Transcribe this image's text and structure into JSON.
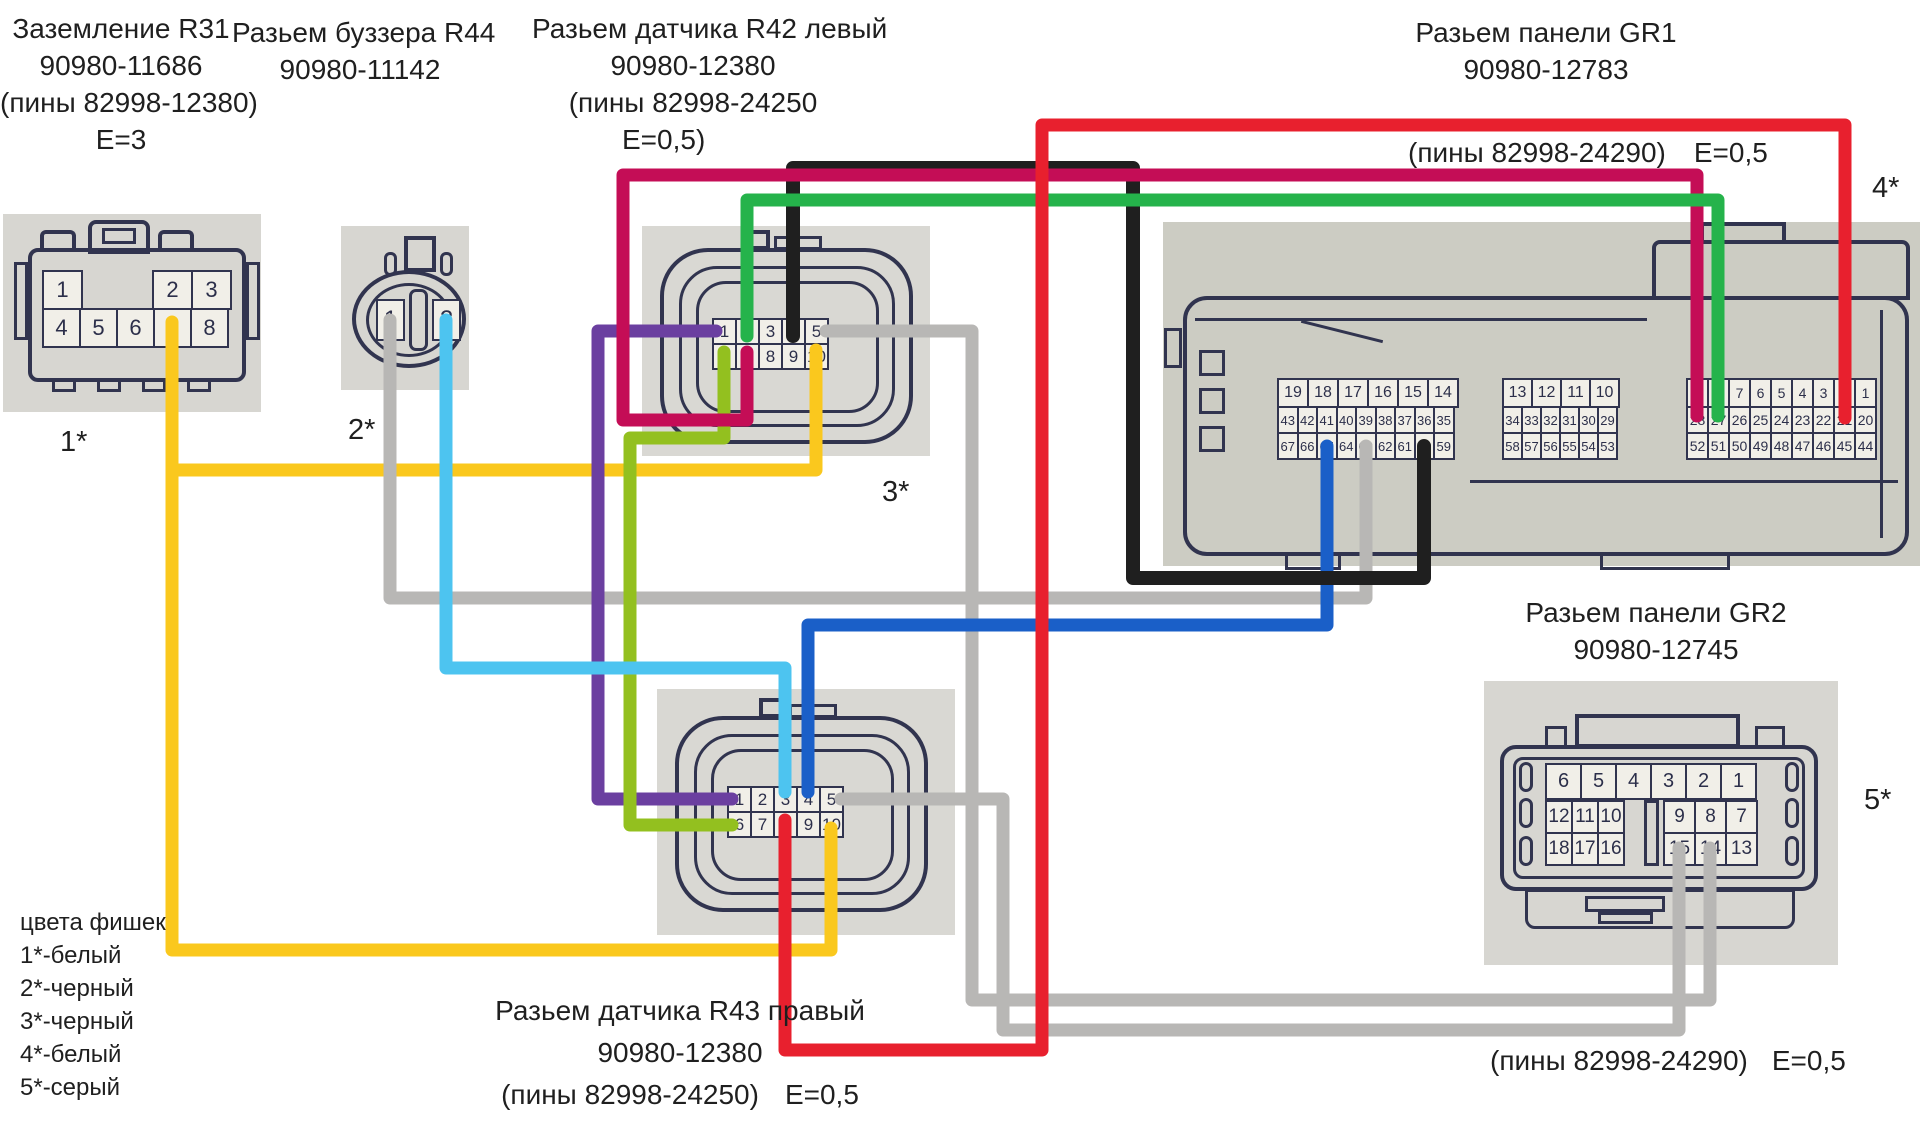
{
  "labels": {
    "r31": {
      "line1": "Заземление R31",
      "line2": "90980-11686",
      "line3": "(пины 82998-12380)",
      "line4": "Е=3",
      "tag": "1*"
    },
    "r44": {
      "line1": "Разьем буззера R44",
      "line2": "90980-11142",
      "tag": "2*"
    },
    "r42": {
      "line1": "Разьем датчика R42 левый",
      "line2": "90980-12380",
      "line3": "(пины 82998-24250",
      "line4": "Е=0,5)",
      "tag": "3*"
    },
    "gr1": {
      "line1": "Разьем панели GR1",
      "line2": "90980-12783",
      "pins_note": "(пины 82998-24290)",
      "e_note": "Е=0,5",
      "tag": "4*"
    },
    "gr2": {
      "line1": "Разьем панели GR2",
      "line2": "90980-12745",
      "pins_note": "(пины 82998-24290)",
      "e_note": "Е=0,5",
      "tag": "5*"
    },
    "r43": {
      "line1": "Разьем датчика R43 правый",
      "line2": "90980-12380",
      "line3": "(пины 82998-24250)",
      "e_note": "Е=0,5"
    }
  },
  "legend": {
    "title": "цвета фишек",
    "items": [
      "1*-белый",
      "2*-черный",
      "3*-черный",
      "4*-белый",
      "5*-серый"
    ]
  },
  "connectors": {
    "r31": {
      "row1a": [
        "1"
      ],
      "row1b": [
        "2",
        "3"
      ],
      "row2": [
        "4",
        "5",
        "6",
        "7",
        "8"
      ]
    },
    "r44": {
      "pins": [
        "1",
        "2"
      ]
    },
    "r42": {
      "row1": [
        "1",
        "2",
        "3",
        "4",
        "5"
      ],
      "row2": [
        "6",
        "7",
        "8",
        "9",
        "10"
      ]
    },
    "r43": {
      "row1": [
        "1",
        "2",
        "3",
        "4",
        "5"
      ],
      "row2": [
        "6",
        "7",
        "8",
        "9",
        "10"
      ]
    },
    "gr1": {
      "left": {
        "top": [
          "19",
          "18",
          "17",
          "16",
          "15",
          "14"
        ],
        "mid": [
          "43",
          "42",
          "41",
          "40",
          "39",
          "38",
          "37",
          "36",
          "35"
        ],
        "bot": [
          "67",
          "66",
          "65",
          "64",
          "63",
          "62",
          "61",
          "60",
          "59"
        ]
      },
      "middle": {
        "top": [
          "13",
          "12",
          "11",
          "10"
        ],
        "mid": [
          "34",
          "33",
          "32",
          "31",
          "30",
          "29"
        ],
        "bot": [
          "58",
          "57",
          "56",
          "55",
          "54",
          "53"
        ]
      },
      "right": {
        "top": [
          "9",
          "8",
          "7",
          "6",
          "5",
          "4",
          "3",
          "2",
          "1"
        ],
        "mid": [
          "28",
          "27",
          "26",
          "25",
          "24",
          "23",
          "22",
          "21",
          "20"
        ],
        "bot": [
          "52",
          "51",
          "50",
          "49",
          "48",
          "47",
          "46",
          "45",
          "44"
        ]
      }
    },
    "gr2": {
      "top": [
        "6",
        "5",
        "4",
        "3",
        "2",
        "1"
      ],
      "left_mid": [
        "12",
        "11",
        "10"
      ],
      "right_mid": [
        "9",
        "8",
        "7"
      ],
      "left_bot": [
        "18",
        "17",
        "16"
      ],
      "right_bot": [
        "15",
        "14",
        "13"
      ]
    }
  },
  "colors": {
    "yellow": "#fac81e",
    "gray": "#b8b7b5",
    "cyan": "#4dc4f0",
    "purple": "#6b3fa0",
    "lime": "#93c01f",
    "blue": "#1a5fc8",
    "black": "#1f1f1f",
    "crimson": "#c40d56",
    "green": "#25b34b",
    "red": "#e8202e",
    "lineart": "#31344f",
    "photo": "#d7d6d1"
  },
  "wires": [
    {
      "name": "yellow-ground-to-R42-pin10",
      "color": "#fac81e",
      "width": 13,
      "points": [
        [
          172,
          322
        ],
        [
          172,
          470
        ],
        [
          816,
          470
        ],
        [
          816,
          350
        ]
      ]
    },
    {
      "name": "yellow-ground-to-R43-pin10",
      "color": "#fac81e",
      "width": 13,
      "points": [
        [
          172,
          470
        ],
        [
          172,
          950
        ],
        [
          831,
          950
        ],
        [
          831,
          828
        ]
      ]
    },
    {
      "name": "gray-R44-pin1-to-GR1-pin63",
      "color": "#b8b7b5",
      "width": 13,
      "points": [
        [
          390,
          320
        ],
        [
          390,
          598
        ],
        [
          1366,
          598
        ],
        [
          1366,
          446
        ]
      ]
    },
    {
      "name": "gray-R42-pin5-to-GR2-pin14",
      "color": "#b8b7b5",
      "width": 13,
      "points": [
        [
          826,
          331
        ],
        [
          972,
          331
        ],
        [
          972,
          1000
        ],
        [
          1710,
          1000
        ],
        [
          1710,
          848
        ]
      ]
    },
    {
      "name": "gray-R43-pin5-to-GR2-pin15",
      "color": "#b8b7b5",
      "width": 13,
      "points": [
        [
          841,
          799
        ],
        [
          1003,
          799
        ],
        [
          1003,
          1030
        ],
        [
          1679,
          1030
        ],
        [
          1679,
          848
        ]
      ]
    },
    {
      "name": "purple-R42-pin1-to-R43-pin1",
      "color": "#6b3fa0",
      "width": 13,
      "points": [
        [
          716,
          331
        ],
        [
          598,
          331
        ],
        [
          598,
          799
        ],
        [
          732,
          799
        ]
      ]
    },
    {
      "name": "lime-R42-pin6-to-R43-pin6",
      "color": "#93c01f",
      "width": 13,
      "points": [
        [
          724,
          352
        ],
        [
          724,
          438
        ],
        [
          630,
          438
        ],
        [
          630,
          825
        ],
        [
          732,
          825
        ]
      ]
    },
    {
      "name": "cyan-R44-pin2-to-R43-pin3",
      "color": "#4dc4f0",
      "width": 13,
      "points": [
        [
          446,
          320
        ],
        [
          446,
          668
        ],
        [
          785,
          668
        ],
        [
          785,
          792
        ]
      ]
    },
    {
      "name": "blue-GR1-pin65-to-R43-pin4",
      "color": "#1a5fc8",
      "width": 13,
      "points": [
        [
          1327,
          446
        ],
        [
          1327,
          625
        ],
        [
          808,
          625
        ],
        [
          808,
          792
        ]
      ]
    },
    {
      "name": "black-R42-pin4-to-GR1-pin60",
      "color": "#1f1f1f",
      "width": 14,
      "points": [
        [
          793,
          336
        ],
        [
          793,
          168
        ],
        [
          1133,
          168
        ],
        [
          1133,
          578
        ],
        [
          1424,
          578
        ],
        [
          1424,
          446
        ]
      ]
    },
    {
      "name": "crimson-R42-pin7-to-GR1-pin28",
      "color": "#c40d56",
      "width": 13,
      "points": [
        [
          747,
          352
        ],
        [
          747,
          420
        ],
        [
          623,
          420
        ],
        [
          623,
          175
        ],
        [
          1697,
          175
        ],
        [
          1697,
          416
        ]
      ]
    },
    {
      "name": "green-R42-pin2-to-GR1-pin27",
      "color": "#25b34b",
      "width": 13,
      "points": [
        [
          747,
          336
        ],
        [
          747,
          200
        ],
        [
          1718,
          200
        ],
        [
          1718,
          416
        ]
      ]
    },
    {
      "name": "red-R43-pin8-to-GR1-pin21",
      "color": "#e8202e",
      "width": 13,
      "points": [
        [
          785,
          820
        ],
        [
          785,
          1050
        ],
        [
          1042,
          1050
        ],
        [
          1042,
          125
        ],
        [
          1845,
          125
        ],
        [
          1845,
          418
        ]
      ]
    }
  ]
}
